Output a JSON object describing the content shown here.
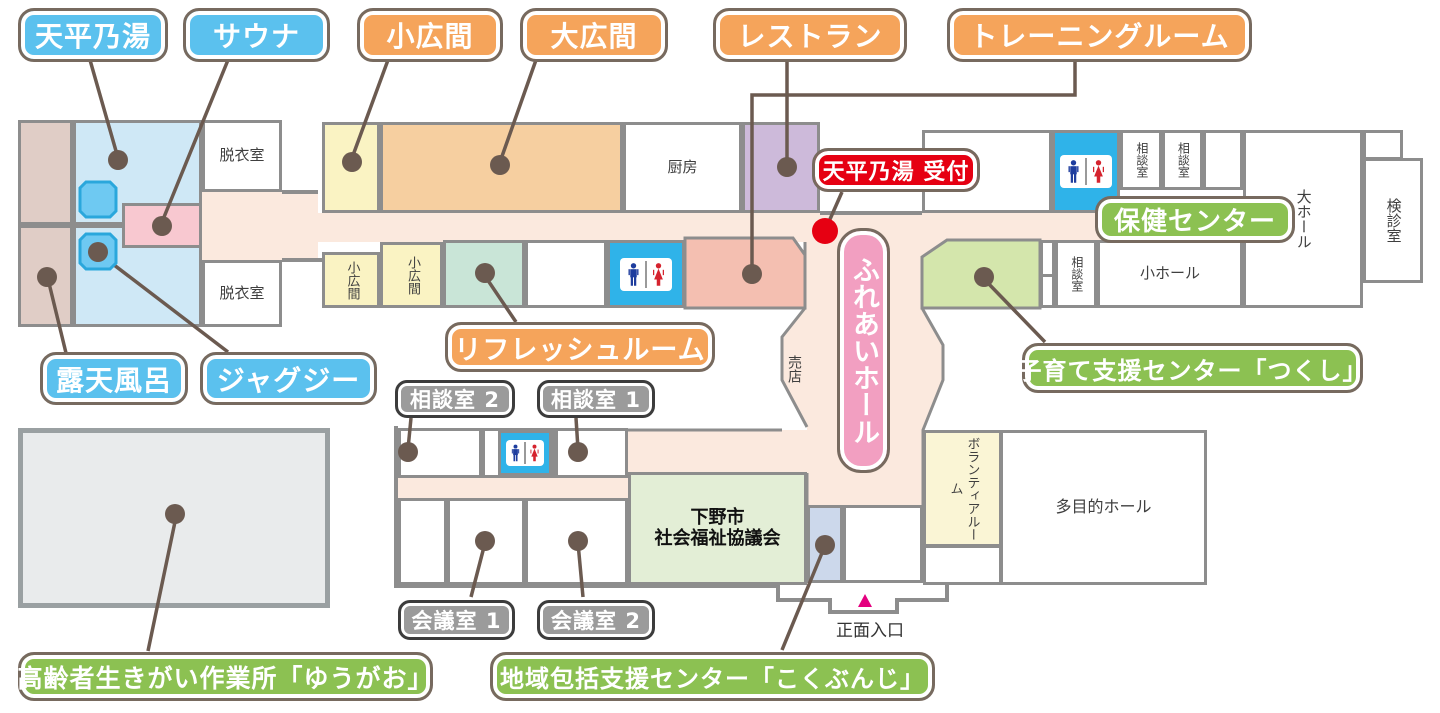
{
  "callouts": {
    "tenpyo_no_yu": "天平乃湯",
    "sauna": "サウナ",
    "kohiroma": "小広間",
    "ohiroma": "大広間",
    "restaurant": "レストラン",
    "training_room": "トレーニングルーム",
    "tenpyo_reception": "天平乃湯 受付",
    "hoken_center": "保健センター",
    "rotenburo": "露天風呂",
    "jacuzzi": "ジャグジー",
    "refresh_room": "リフレッシュルーム",
    "soudan2": "相談室 2",
    "soudan1": "相談室 1",
    "kosodate_center": "子育て支援センター「つくし」",
    "kaigi1": "会議室 1",
    "kaigi2": "会議室 2",
    "sagyousho": "高齢者生きがい作業所「ゆうがお」",
    "chiiki_center": "地域包括支援センター「こくぶんじ」",
    "fureai_hall": "ふれあいホール"
  },
  "room_texts": {
    "datsuishitsu_1": "脱衣室",
    "datsuishitsu_2": "脱衣室",
    "chubo": "厨房",
    "kohiroma_a": "小広間",
    "kohiroma_b": "小広間",
    "soudanshitsu_a": "相談室",
    "soudanshitsu_b": "相談室",
    "soudanshitsu_c": "相談室",
    "dai_hall": "大ホール",
    "kenshinshitsu": "検診室",
    "sho_hall": "小ホール",
    "baiten": "売店",
    "volunteer_room": "ボランティアルーム",
    "tamokuteki_hall": "多目的ホール",
    "shakyo_line1": "下野市",
    "shakyo_line2": "社会福祉協議会",
    "shomen_iriguchi": "正面入口"
  },
  "icons": {
    "restroom": "man-woman-pictogram",
    "entrance_marker": "pink-triangle-up",
    "reception_marker": "red-dot",
    "location_marker": "brown-dot",
    "pool": "blue-octagon"
  },
  "colors": {
    "callout_blue": "#5bc1ee",
    "callout_orange": "#f5a45b",
    "callout_green": "#8cc152",
    "callout_gray": "#9b9b9b",
    "callout_red": "#e60012",
    "callout_pink": "#f29fc1",
    "callout_border": "#776a5f",
    "wall_gray": "#8d8d8d",
    "corridor_cream": "#fbe9de",
    "bath_blue": "#cfe8f6",
    "pool_blue": "#6ec9f2",
    "open_air_tan": "#e0cdc6",
    "sauna_pink": "#f8c8d0",
    "room_yellow": "#faf3c3",
    "room_orange": "#f6cfa0",
    "room_purple": "#cdbada",
    "room_mint": "#c9e5d7",
    "room_salmon": "#f4bfb1",
    "room_green": "#d4e6ac",
    "room_palegreen": "#e3eed6",
    "room_lightblue": "#ccd8eb",
    "room_paleyellow": "#faf5d5",
    "toilet_blue": "#2fb3e9",
    "marker_brown": "#6b5a50",
    "entrance_pink": "#e4007f",
    "workshop_gray": "#e9ebec"
  }
}
